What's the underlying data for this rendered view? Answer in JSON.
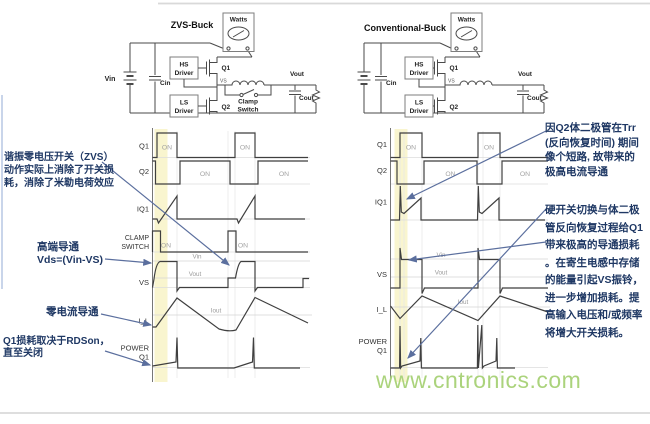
{
  "watermark": "www.cntronics.com",
  "on_label": "ON",
  "left": {
    "title": "ZVS-Buck",
    "circuit": {
      "vin": "Vin",
      "cin": "Cin",
      "hs1": "HS",
      "hs2": "Driver",
      "ls1": "LS",
      "ls2": "Driver",
      "q1": "Q1",
      "q2": "Q2",
      "vs": "VS",
      "clamp1": "Clamp",
      "clamp2": "Switch",
      "cout": "Cout",
      "vout": "Vout",
      "watts": "Watts"
    },
    "rows": {
      "q1": "Q1",
      "q2": "Q2",
      "iq1": "IQ1",
      "clamp1": "CLAMP",
      "clamp2": "SWITCH",
      "vs": "VS",
      "il": "I_L",
      "power1": "POWER",
      "power2": "Q1"
    },
    "refs": {
      "vin": "Vin",
      "vout": "Vout",
      "iout": "Iout"
    }
  },
  "right": {
    "title": "Conventional-Buck",
    "circuit": {
      "cin": "Cin",
      "hs1": "HS",
      "hs2": "Driver",
      "ls1": "LS",
      "ls2": "Driver",
      "q1": "Q1",
      "q2": "Q2",
      "vs": "VS",
      "cout": "Cout",
      "vout": "Vout",
      "watts": "Watts"
    },
    "rows": {
      "q1": "Q1",
      "q2": "Q2",
      "iq1": "IQ1",
      "vs": "VS",
      "il": "I_L",
      "power1": "POWER",
      "power2": "Q1"
    },
    "refs": {
      "vin": "Vin",
      "vout": "Vout",
      "iout": "Iout"
    }
  },
  "annotations": {
    "zvs": {
      "lines": [
        "谐振零电压开关（ZVS）",
        "动作实际上消除了开关损",
        "耗，消除了米勒电荷效应"
      ]
    },
    "high_side": {
      "lines": [
        "高端导通",
        "Vds=(Vin-VS)"
      ]
    },
    "zero_current": {
      "lines": [
        "零电流导通"
      ]
    },
    "rdson": {
      "lines": [
        "Q1损耗取决于RDSon，",
        "直至关闭"
      ]
    },
    "trr": {
      "lines": [
        "因Q2体二极管在Trr",
        "(反向恢复时间) 期间",
        "像个短路, 故带来的",
        "极高电流导通"
      ]
    },
    "hard_switch": {
      "lines": [
        "硬开关切换与体二极",
        "管反向恢复过程给Q1",
        "带来极高的导通损耗",
        "。在寄生电感中存储",
        "的能量引起VS振铃，",
        "进一步增加损耗。提",
        "高输入电压和/或频率",
        "将增大开关损耗。"
      ]
    }
  },
  "colors": {
    "annotation": "#1f3864",
    "arrow": "#5b6f9e",
    "waveform": "#3f3f3f",
    "highlight": "#f9f5cf",
    "watermark": "#abd37c",
    "grid": "#dcdcdc"
  }
}
